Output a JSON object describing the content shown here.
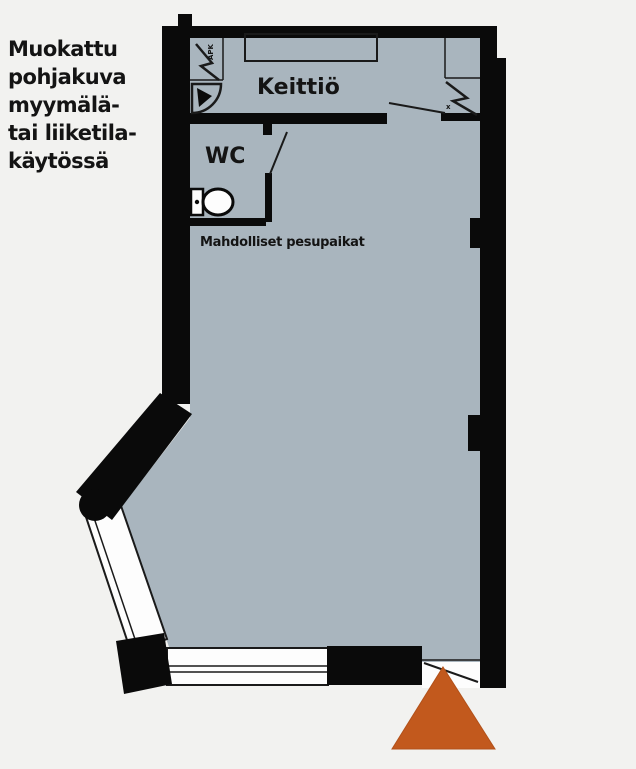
{
  "title": {
    "lines": [
      "Muokattu",
      "pohjakuva",
      "myymälä-",
      "tai liiketila-",
      "käytössä"
    ]
  },
  "labels": {
    "kitchen": "Keittiö",
    "wc": "WC",
    "washing_spots": "Mahdolliset pesupaikat",
    "appliance": "APK",
    "closet_mark": "x"
  },
  "icons": {
    "toilet": "toilet-icon",
    "corner_drain": "corner-drain-icon",
    "folding_door": "folding-door-zigzag-icon",
    "entrance_marker": "entrance-triangle"
  },
  "colors": {
    "background": "#f2f2f0",
    "floor": "#a9b5be",
    "wall": "#0a0a0a",
    "window": "#fdfdfd",
    "line": "#1a1a1a",
    "entrance_triangle": "#c2591d",
    "text": "#141414"
  }
}
